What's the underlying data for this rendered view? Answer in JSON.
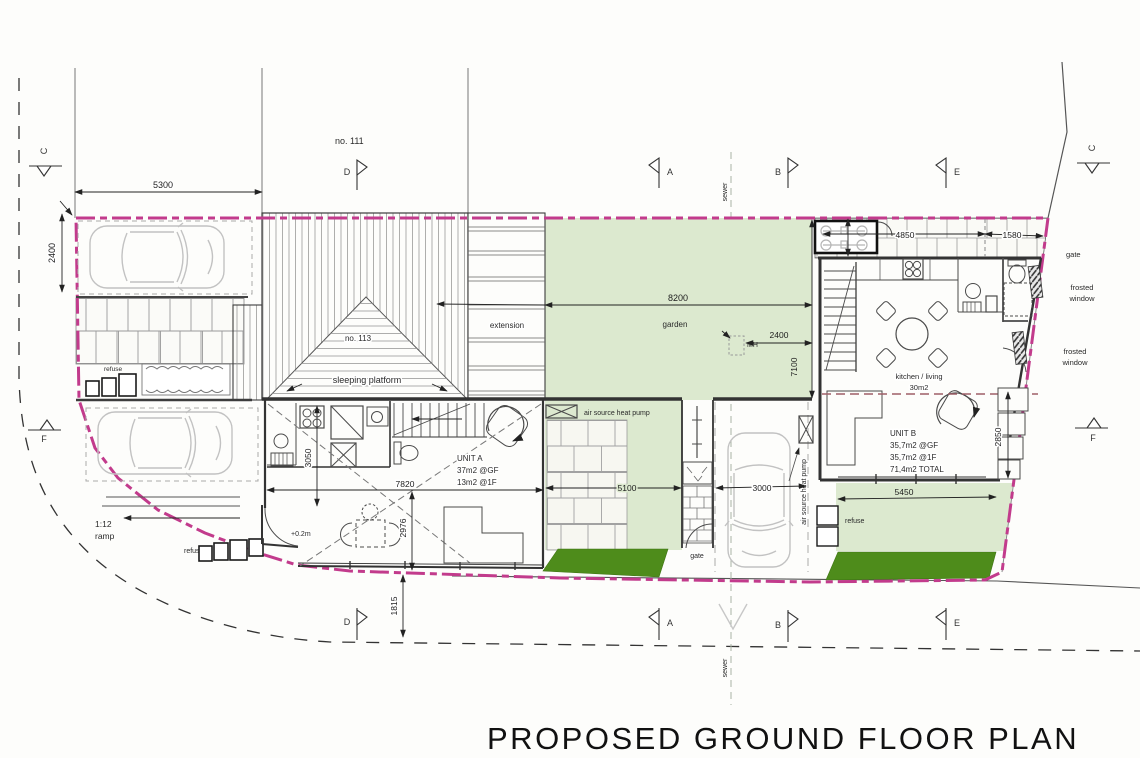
{
  "title": "PROPOSED GROUND FLOOR PLAN",
  "labels": {
    "no_111": "no. 111",
    "no_113": "no. 113",
    "sleeping_platform": "sleeping platform",
    "extension": "extension",
    "garden": "garden",
    "mh": "MH",
    "sewer": "sewer",
    "gate": "gate",
    "frosted": "frosted",
    "window": "window",
    "refuse": "refuse",
    "ramp_ratio": "1:12",
    "ramp": "ramp",
    "level": "+0.2m",
    "ashp": "air source heat pump",
    "kitchen_living": "kitchen / living",
    "kitchen_area": "30m2"
  },
  "unit_a": {
    "name": "UNIT A",
    "gf": "37m2 @GF",
    "ff": "13m2 @1F"
  },
  "unit_b": {
    "name": "UNIT B",
    "gf": "35,7m2 @GF",
    "ff": "35,7m2 @1F",
    "total": "71,4m2 TOTAL"
  },
  "dims": {
    "plot_width": "5300",
    "bay_depth": "2400",
    "garden_width": "8200",
    "mh_offset": "2400",
    "garden_depth": "7100",
    "walk_a": "4850",
    "walk_b": "1580",
    "patio_b": "5450",
    "terrace_b": "2850",
    "patio_a": "5100",
    "park_width": "3000",
    "unit_a_width": "7820",
    "unit_a_kitchen": "3050",
    "unit_a_living": "2976",
    "front_offset": "1815"
  },
  "markers": {
    "a": "A",
    "b": "B",
    "c": "C",
    "d": "D",
    "e": "E",
    "f": "F"
  },
  "colors": {
    "boundary": "#c23b8c",
    "garden": "#dce9cf",
    "hedge": "#4e8c1b"
  }
}
